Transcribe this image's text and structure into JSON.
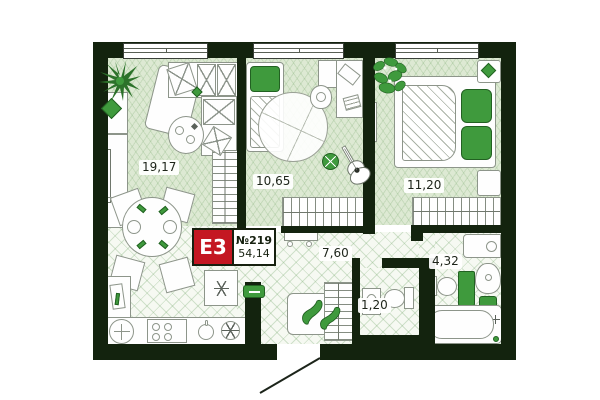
{
  "unit": {
    "type_label": "E3",
    "number_label": "№219",
    "total_area": "54,14"
  },
  "rooms": [
    {
      "key": "living-kitchen",
      "area": "19,17"
    },
    {
      "key": "bedroom-1",
      "area": "10,65"
    },
    {
      "key": "bedroom-2",
      "area": "11,20"
    },
    {
      "key": "hallway",
      "area": "7,60"
    },
    {
      "key": "bathroom",
      "area": "4,32"
    },
    {
      "key": "wc",
      "area": "1,20"
    }
  ],
  "colors": {
    "wall": "#13230e",
    "room_floor": "#dde9d3",
    "wet_floor": "#f6f9f2",
    "accent_green": "#3f9a3d",
    "badge_red": "#c41722"
  }
}
